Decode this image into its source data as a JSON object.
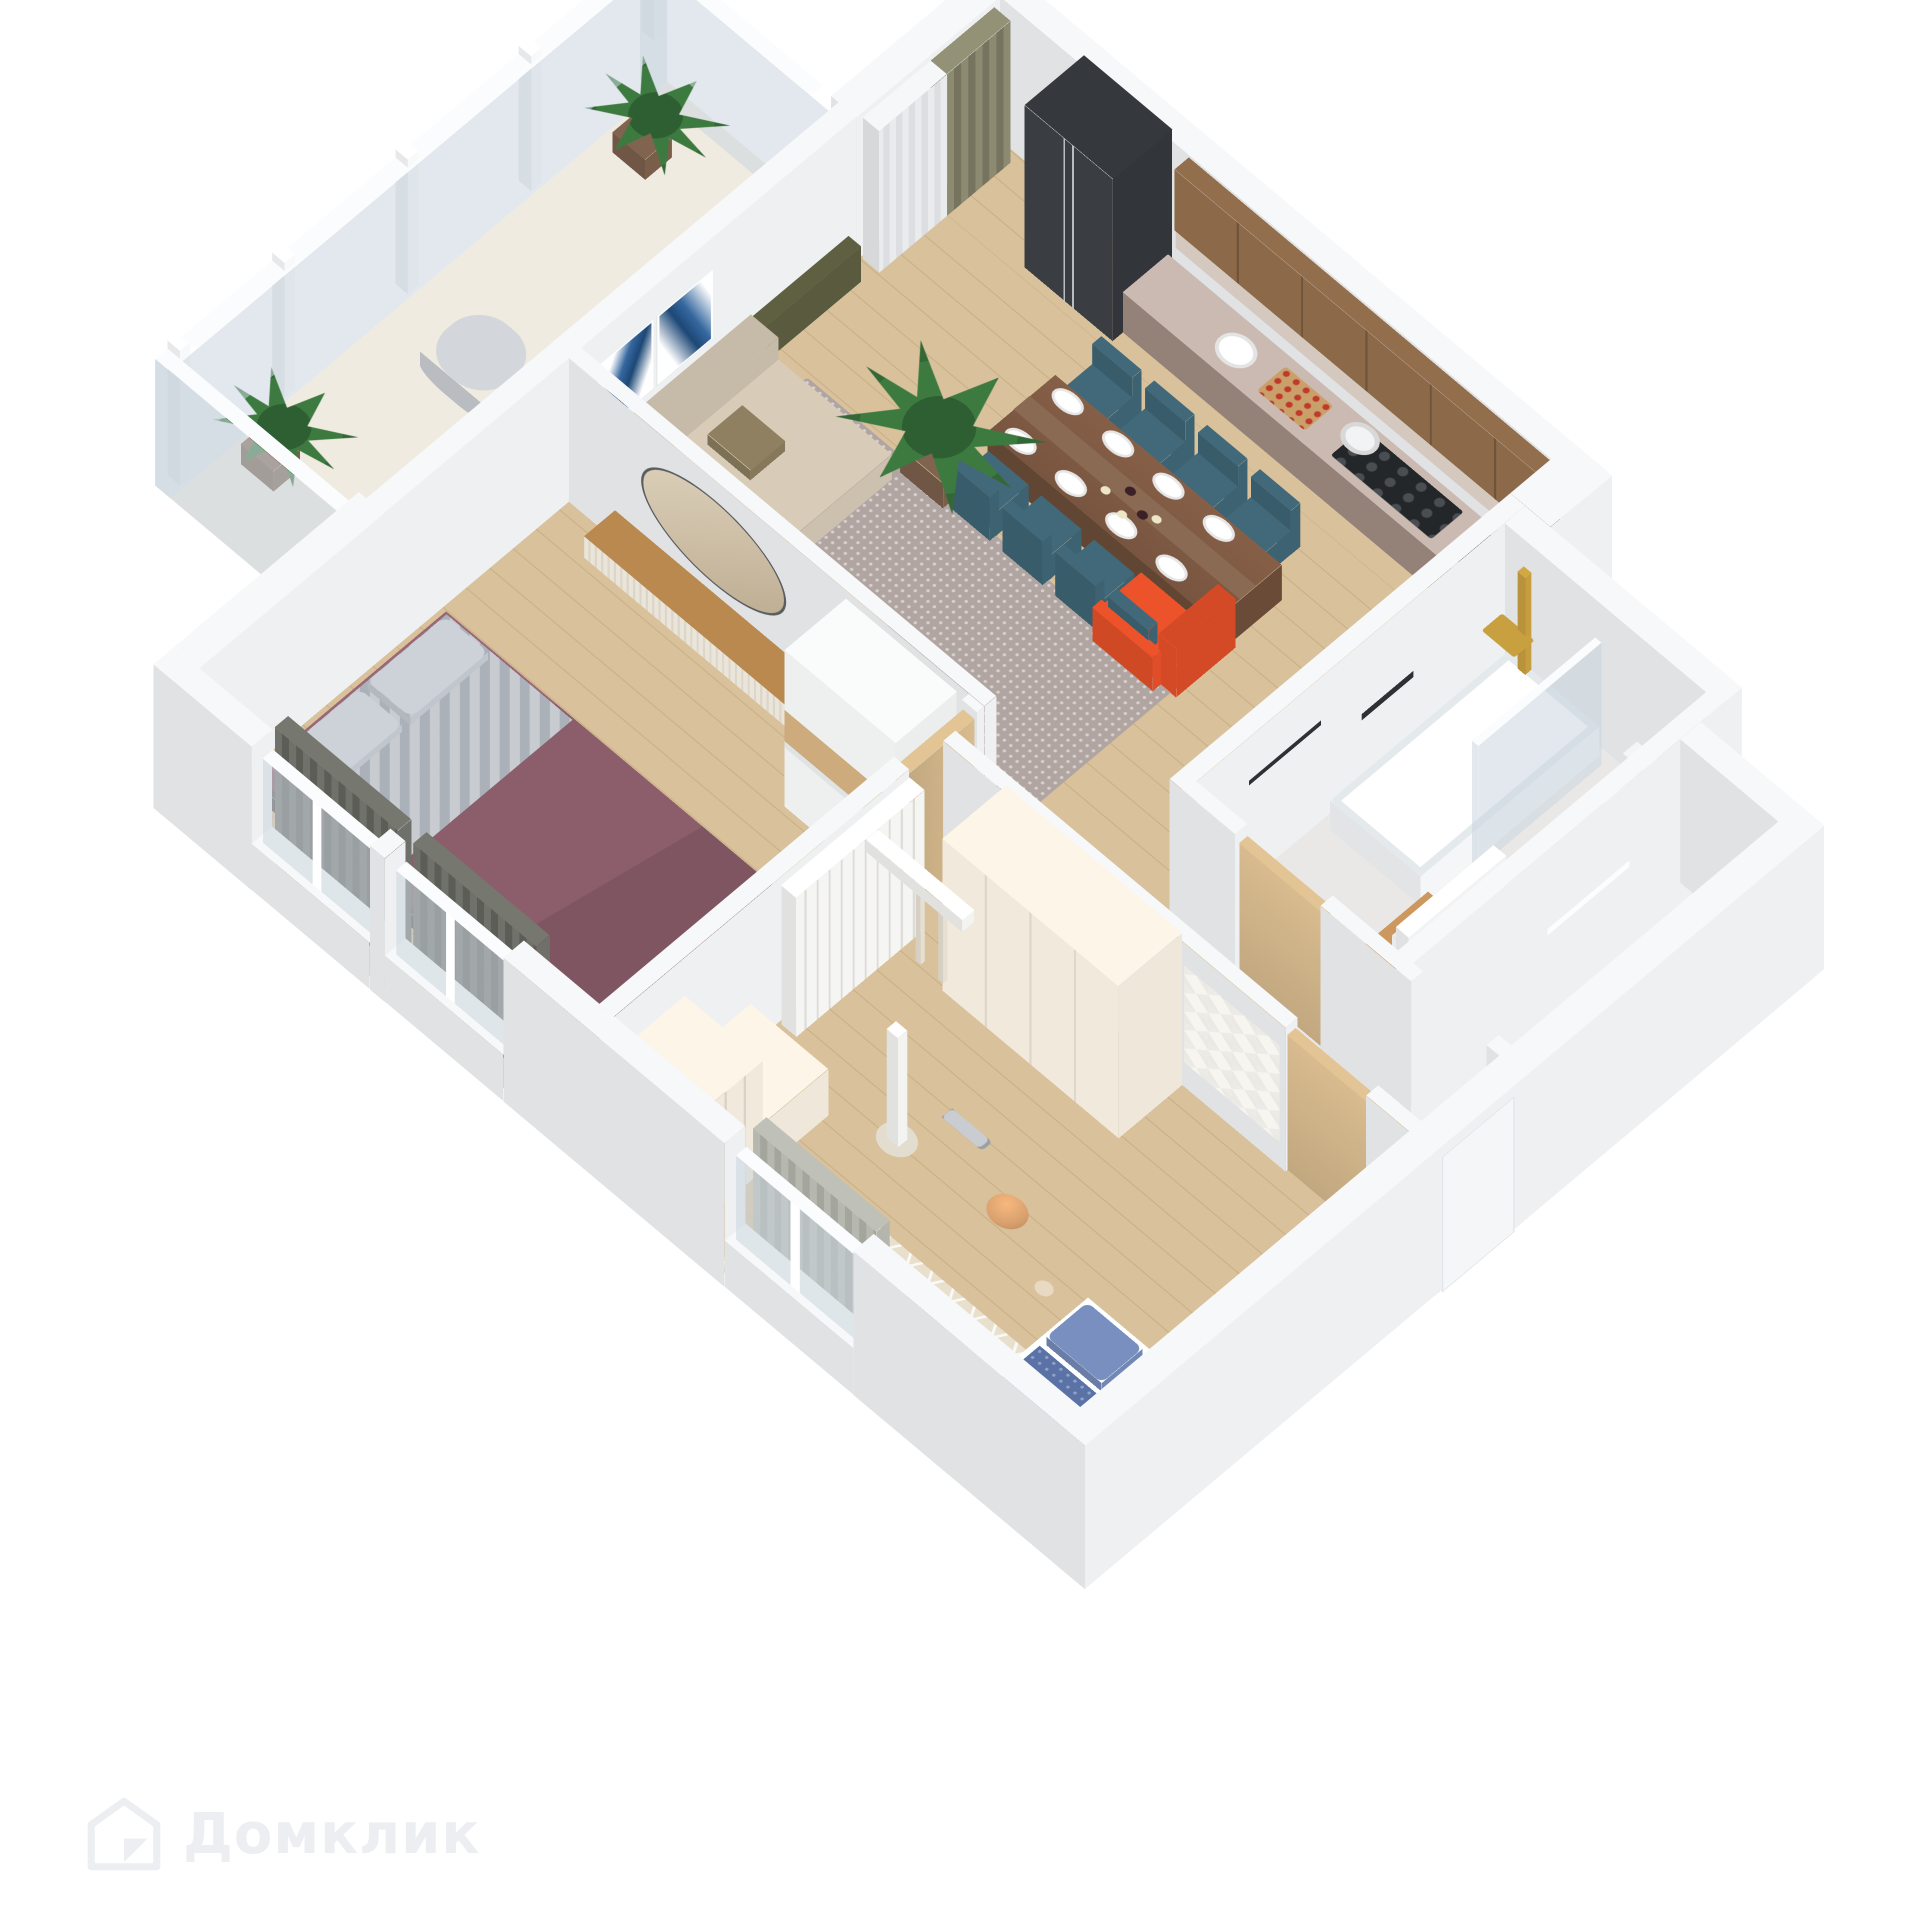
{
  "watermark": {
    "brand": "Домклик",
    "logo_icon": "domclick-house-icon"
  },
  "scene": {
    "type": "isometric-3d-floorplan",
    "description": "3D rendered floor plan of a two-bedroom apartment with open kitchen-living room, balcony, bathroom, storage, hallway, master bedroom and kids room",
    "background": "#ffffff"
  },
  "palette": {
    "wall": "#eef0f2",
    "wallTop": "#f7f8f9",
    "wallOuter": "#e9ebee",
    "glass": "rgba(203,214,222,0.55)",
    "frame": "#fbfcfd",
    "woodFloor": "#d8c19b",
    "woodLine": "#c8ae84",
    "balconyFloor": "#f0ebe0",
    "bathFloor": "#e9e8e6",
    "mosaic": "#41454b",
    "storeFloor": "#eef0f2",
    "counter": "#a18d84",
    "counterTop": "#cbbab1",
    "cabinetWood": "#8c6948",
    "backsplash": "#d4c8bf",
    "fridge": "#32363a",
    "cooktop": "#24272a",
    "sink": "#3b3f43",
    "table": "#6b4c39",
    "runner": "#8a6a52",
    "chair": "#3e6474",
    "sofa": "#cec2b0",
    "pillowOlive": "#877a5c",
    "rug": "#b1a5a2",
    "armchair": "#e14f28",
    "plant": "#3c7a3f",
    "plantDark": "#2e5f33",
    "pot": "#7a5f4b",
    "artBlue": "#36689f",
    "artDeep": "#1d4877",
    "consoleWood": "#b9894f",
    "consoleWhite": "#eae5da",
    "mirror": "#cfc0a8",
    "wardrobe": "#eef0ef",
    "wardrobeWood": "#cdab7c",
    "bedPlum": "#8c5e6c",
    "bedBase": "#55514c",
    "blanket": "#abb1b9",
    "pillow": "#c3c8cf",
    "curtainOlive": "#8c8a70",
    "curtainSheer": "#eaebed",
    "curtainGraphite": "#70716a",
    "door": "#d8bb8e",
    "gold": "#c8a040",
    "tub": "#f6f8f9",
    "vanity": "#b98a55",
    "white": "#f4f5f6",
    "black": "#2e3134",
    "kidsCream": "#f1e9dc",
    "gym": "#f5f5f3",
    "kidsBed": "#5b72a7",
    "kidsPillow": "#7288b6",
    "dotPillow": "#d9dde3",
    "kidsRug": "#e8dfcd",
    "mat": "#c9a06a",
    "ball": "#d8a06e",
    "plush": "#b9bdc2",
    "star": "#6fc2c9",
    "pink": "#e8c9cf",
    "watermarkColor": "#eceef2"
  },
  "rooms": [
    {
      "id": "kitchen-living",
      "label": "Kitchen-living room",
      "furniture": [
        "fridge",
        "kitchen-counter",
        "upper-cabinets",
        "cooktop",
        "kitchen-sink",
        "dining-table",
        "dining-chairs-teal-x8",
        "plates",
        "wine-bottles",
        "corner-sofa",
        "wall-art-x2",
        "area-rug",
        "orange-armchair",
        "potted-plant",
        "window-curtains"
      ]
    },
    {
      "id": "balcony",
      "label": "Glazed balcony",
      "furniture": [
        "glass-panels",
        "plant-x2",
        "teal-cushion",
        "beanbag"
      ]
    },
    {
      "id": "bathroom",
      "label": "Bathroom",
      "furniture": [
        "shower-gold",
        "glass-screen",
        "bathtub",
        "toilet",
        "vanity-sink",
        "towel-bar",
        "shelf-bottles",
        "mosaic-tile"
      ]
    },
    {
      "id": "storage",
      "label": "Storage / laundry room",
      "furniture": [
        "wall-shelf",
        "boiler"
      ]
    },
    {
      "id": "hallway",
      "label": "Hallway",
      "furniture": [
        "bedroom-door",
        "bathroom-door",
        "kids-door",
        "front-door",
        "plant-small"
      ]
    },
    {
      "id": "bedroom",
      "label": "Master bedroom",
      "furniture": [
        "double-bed-plum",
        "round-mirror",
        "floating-console",
        "sliding-wardrobe",
        "windows-x2",
        "curtains-graphite"
      ]
    },
    {
      "id": "kids-room",
      "label": "Kids room",
      "furniture": [
        "swedish-wall-gym",
        "climbing-pole",
        "cream-wardrobe",
        "origami-wall-decor",
        "desk-shelves",
        "kids-bed-blue",
        "play-rug",
        "basketball",
        "dumbbells",
        "plush-whale",
        "starfish",
        "window-curtain"
      ]
    }
  ]
}
